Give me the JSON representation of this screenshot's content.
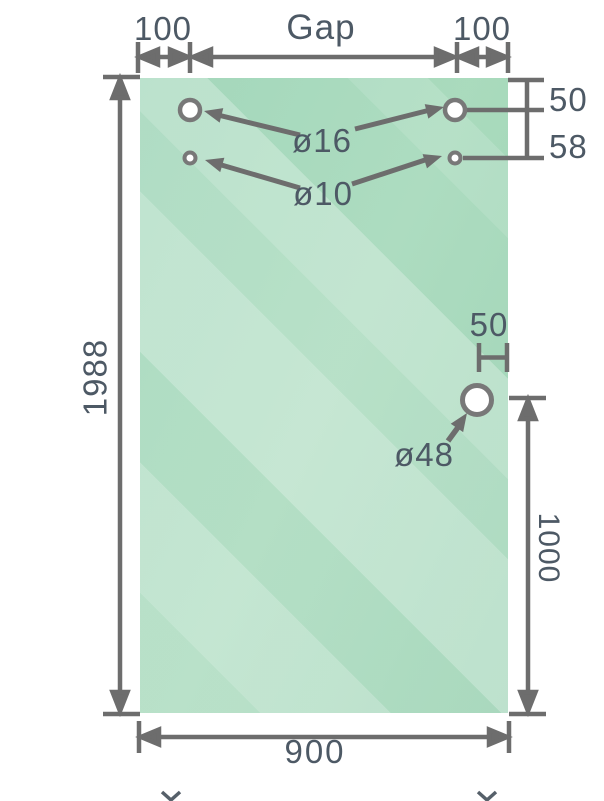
{
  "drawing": {
    "type": "glass-panel-dimension-drawing",
    "dimensions": {
      "top_left_hole_offset": "100",
      "gap": "Gap",
      "top_right_hole_offset": "100",
      "hole_top_margin": "50",
      "hole_vertical_spacing": "58",
      "panel_height": "1988",
      "handle_hole_edge_offset": "50",
      "handle_hole_height": "1000",
      "panel_width": "900"
    },
    "hole_labels": {
      "large_top_holes": "ø16",
      "small_top_holes": "ø10",
      "handle_hole": "ø48"
    },
    "colors": {
      "glass_green": "#a6d9ba",
      "glass_highlight": "#c4e7d2",
      "line_gray": "#6d6d6d",
      "hole_ring_gray": "#787878",
      "text_slate": "#4d5965",
      "background": "#ffffff"
    }
  }
}
